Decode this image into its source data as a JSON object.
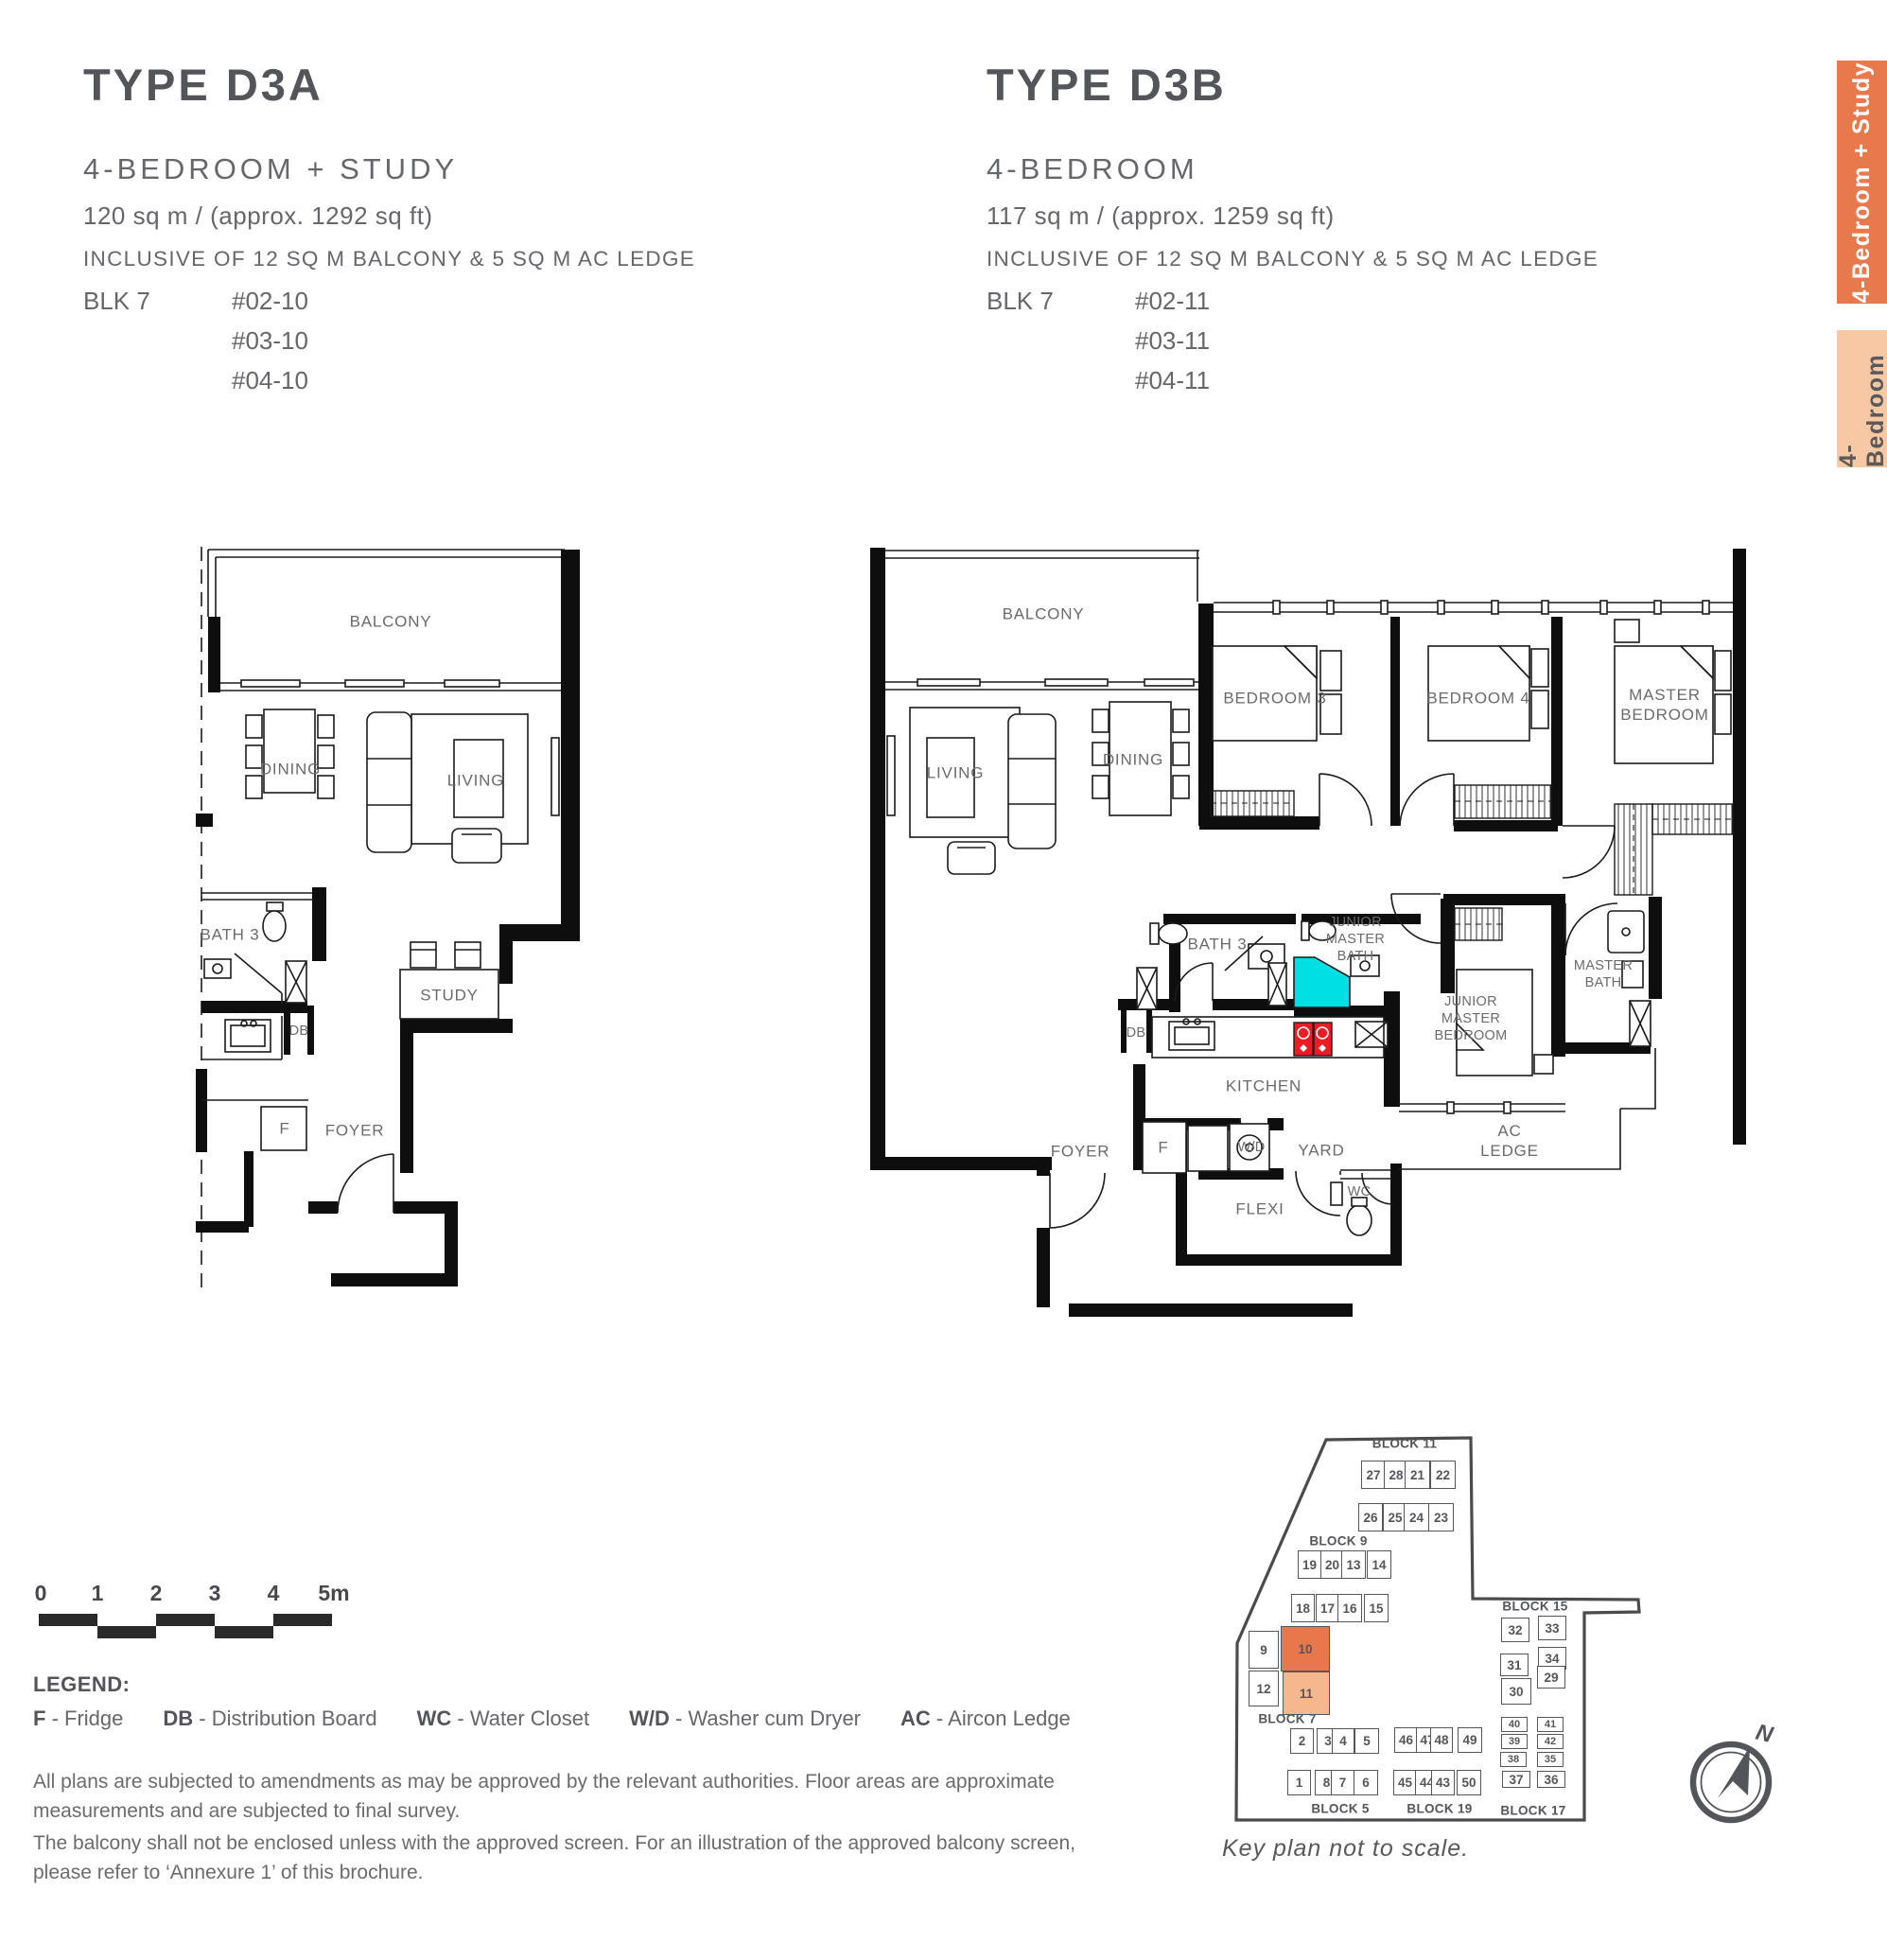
{
  "colors": {
    "tab_active_bg": "#E8794C",
    "tab_inactive_bg": "#F8C7A4",
    "highlight_dark": "#E8774B",
    "highlight_light": "#F6B78F",
    "shower_cyan": "#00DFE4",
    "hob_red": "#EC1C24",
    "text_gray": "#58595B"
  },
  "units": [
    {
      "type_label": "TYPE D3A",
      "config": "4-BEDROOM + STUDY",
      "area": "120 sq m / (approx. 1292 sq ft)",
      "inclusive": "INCLUSIVE OF 12 SQ M BALCONY & 5 SQ M AC LEDGE",
      "block": "BLK 7",
      "stacks": [
        "#02-10",
        "#03-10",
        "#04-10"
      ]
    },
    {
      "type_label": "TYPE D3B",
      "config": "4-BEDROOM",
      "area": "117 sq m / (approx. 1259 sq ft)",
      "inclusive": "INCLUSIVE OF 12 SQ M BALCONY & 5 SQ M AC LEDGE",
      "block": "BLK 7",
      "stacks": [
        "#02-11",
        "#03-11",
        "#04-11"
      ]
    }
  ],
  "tabs": [
    {
      "label": "4-Bedroom + Study",
      "active": true
    },
    {
      "label": "4-Bedroom",
      "active": false
    }
  ],
  "plans": {
    "d3a": {
      "labels": {
        "balcony": "BALCONY",
        "dining": "DINING",
        "living": "LIVING",
        "bath3": "BATH 3",
        "study": "STUDY",
        "db": "DB",
        "fridge": "F",
        "foyer": "FOYER"
      }
    },
    "d3b": {
      "labels": {
        "balcony": "BALCONY",
        "living": "LIVING",
        "dining": "DINING",
        "bedroom3": "BEDROOM 3",
        "bedroom4": "BEDROOM 4",
        "master_bedroom": "MASTER\nBEDROOM",
        "bath3": "BATH 3",
        "junior_master_bath": "JUNIOR\nMASTER\nBATH",
        "junior_master_bedroom": "JUNIOR\nMASTER\nBEDROOM",
        "master_bath": "MASTER\nBATH",
        "db": "DB",
        "kitchen": "KITCHEN",
        "fridge": "F",
        "wd": "W/D",
        "yard": "YARD",
        "flexi": "FLEXI",
        "wc": "WC",
        "foyer": "FOYER",
        "ac_ledge": "AC\nLEDGE"
      }
    }
  },
  "scale_bar": {
    "ticks": [
      "0",
      "1",
      "2",
      "3",
      "4",
      "5m"
    ]
  },
  "legend": {
    "heading": "LEGEND:",
    "items": [
      {
        "abbr": "F",
        "desc": "Fridge"
      },
      {
        "abbr": "DB",
        "desc": "Distribution Board"
      },
      {
        "abbr": "WC",
        "desc": "Water Closet"
      },
      {
        "abbr": "W/D",
        "desc": "Washer cum Dryer"
      },
      {
        "abbr": "AC",
        "desc": "Aircon Ledge"
      }
    ]
  },
  "disclaimer": [
    "All plans are subjected to amendments as may be approved by the relevant authorities. Floor areas are approximate measurements and are subjected to final survey.",
    "The balcony shall not be enclosed unless with the approved screen. For an illustration of the approved balcony screen, please refer to ‘Annexure 1’ of this brochure."
  ],
  "key_plan": {
    "note": "Key plan not to scale.",
    "compass": "N",
    "highlight": {
      "dark_unit": "10",
      "light_unit": "11"
    },
    "blocks": [
      {
        "name": "BLOCK 11",
        "rows": [
          [
            "27",
            "28",
            "21",
            "22"
          ],
          [
            "26",
            "25",
            "24",
            "23"
          ]
        ]
      },
      {
        "name": "BLOCK 9",
        "rows": [
          [
            "19",
            "20",
            "13",
            "14"
          ],
          [
            "18",
            "17",
            "16",
            "15"
          ]
        ]
      },
      {
        "name": "BLOCK 7",
        "rows": [
          [
            "9",
            "10"
          ],
          [
            "12",
            "11"
          ]
        ]
      },
      {
        "name": "BLOCK 5",
        "rows": [
          [
            "2",
            "3",
            "4",
            "5"
          ],
          [
            "1",
            "8",
            "7",
            "6"
          ]
        ]
      },
      {
        "name": "BLOCK 19",
        "rows": [
          [
            "46",
            "47",
            "48",
            "49"
          ],
          [
            "45",
            "44",
            "43",
            "50"
          ]
        ]
      },
      {
        "name": "BLOCK 15",
        "rows": [
          [
            "32",
            "33"
          ],
          [
            "31",
            "34"
          ],
          [
            "30",
            "29"
          ]
        ]
      },
      {
        "name": "BLOCK 17",
        "rows": [
          [
            "40",
            "41"
          ],
          [
            "39",
            "42"
          ],
          [
            "38",
            "35"
          ],
          [
            "37",
            "36"
          ]
        ]
      }
    ]
  }
}
